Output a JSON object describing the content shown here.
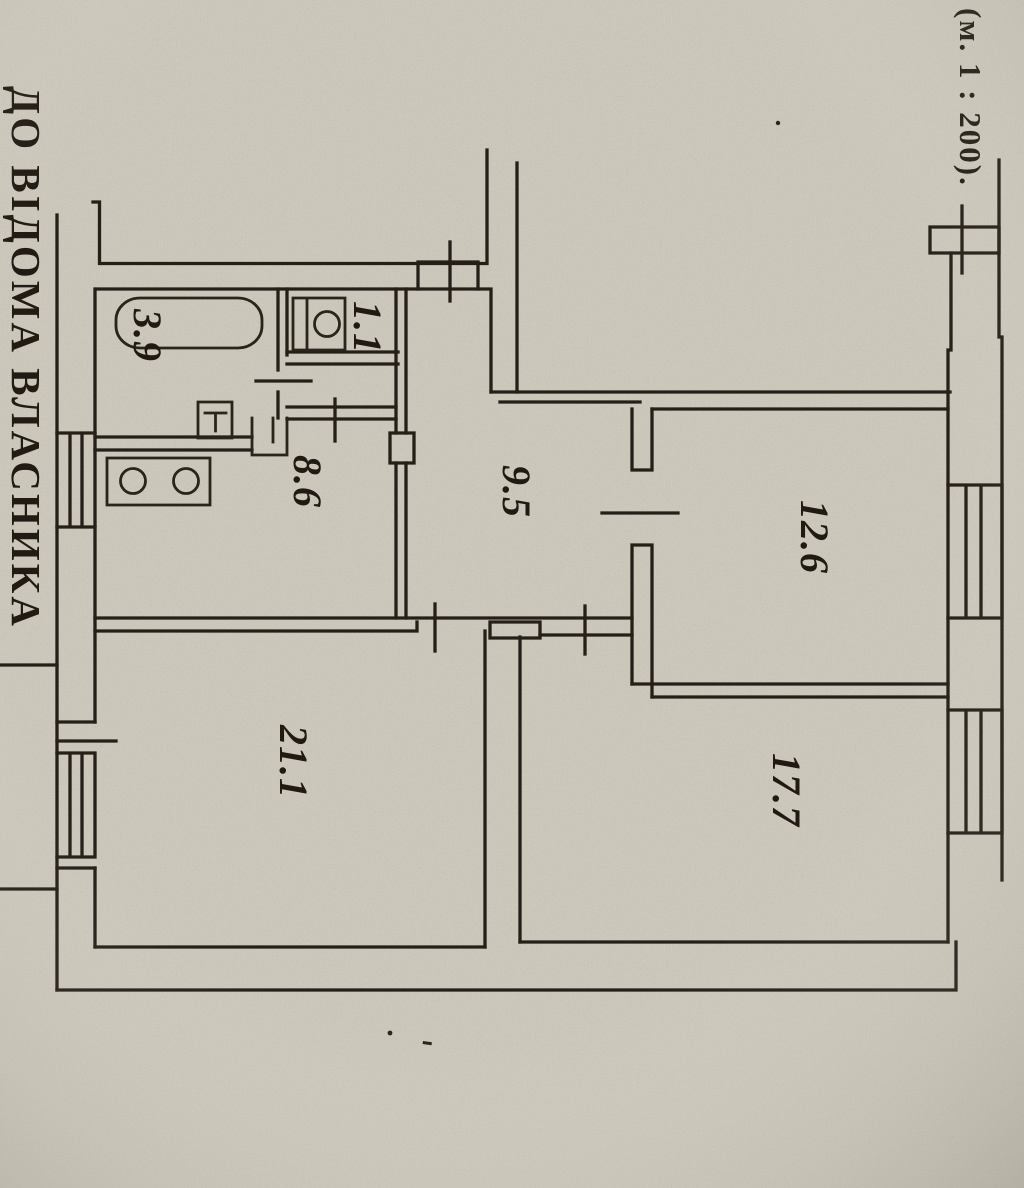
{
  "document": {
    "kind": "scanned apartment floor plan",
    "margin_note_left": "ДО ВІДОМА ВЛАСНИКА",
    "scale_note": "(м. 1 : 200).",
    "paper_color": "#ccc8ba",
    "ink_color": "#251f17"
  },
  "floor_plan": {
    "rooms": [
      {
        "id": "bathroom",
        "area_label": "3.9"
      },
      {
        "id": "wc",
        "area_label": "1.1"
      },
      {
        "id": "kitchen",
        "area_label": "8.6"
      },
      {
        "id": "hallway",
        "area_label": "9.5"
      },
      {
        "id": "room-north",
        "area_label": "12.6"
      },
      {
        "id": "room-east",
        "area_label": "17.7"
      },
      {
        "id": "room-large",
        "area_label": "21.1"
      }
    ],
    "fixtures": [
      "bathtub",
      "toilet",
      "washbasin",
      "stove",
      "cabinet"
    ],
    "openings": [
      "entry-door",
      "bathroom-door",
      "lobby-door",
      "kitchen-door",
      "room-north-door",
      "room-large-door",
      "room-east-door"
    ],
    "windows": [
      "kitchen-window-west",
      "room-large-window-west",
      "room-north-window-east",
      "room-east-window-east",
      "vent-north-east"
    ]
  }
}
